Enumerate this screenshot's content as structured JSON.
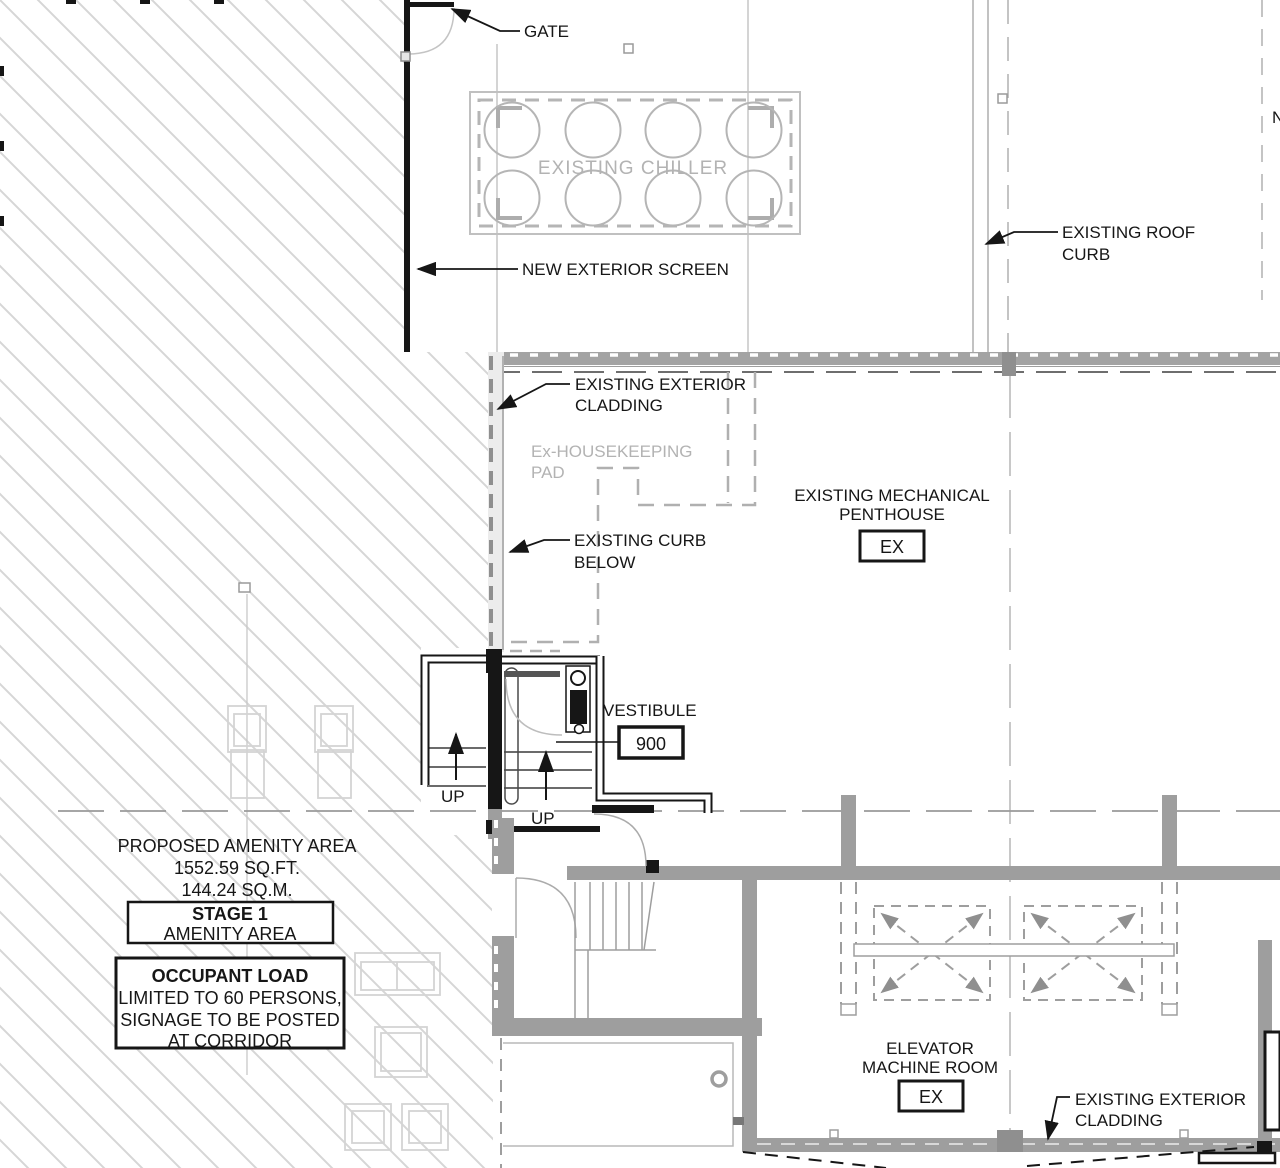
{
  "drawing": {
    "title": "Roof / Penthouse Plan - Stage 1 Amenity Area",
    "colors": {
      "line_black": "#161616",
      "existing_gray": "#9e9e9e",
      "light_line_gray": "#b5b5b5",
      "hatch_gray": "#d6d6d6",
      "gray_text": "#b3b3b3",
      "background": "#ffffff"
    },
    "labels": {
      "gate": "GATE",
      "existing_chiller": "EXISTING CHILLER",
      "new_exterior_screen": "NEW EXTERIOR SCREEN",
      "roof_curb_1": "EXISTING ROOF",
      "roof_curb_2": "CURB",
      "edge_partial": "N",
      "cladding_top_1": "EXISTING EXTERIOR",
      "cladding_top_2": "CLADDING",
      "housekeeping_1": "Ex-HOUSEKEEPING",
      "housekeeping_2": "PAD",
      "penthouse_1": "EXISTING MECHANICAL",
      "penthouse_2": "PENTHOUSE",
      "penthouse_tag": "EX",
      "curb_below_1": "EXISTING CURB",
      "curb_below_2": "BELOW",
      "vestibule": "VESTIBULE",
      "vestibule_number": "900",
      "up_left": "UP",
      "up_right": "UP",
      "amenity_1": "PROPOSED AMENITY AREA",
      "amenity_2": "1552.59 SQ.FT.",
      "amenity_3": "144.24 SQ.M.",
      "stage_1": "STAGE 1",
      "stage_2": "AMENITY AREA",
      "occupant_1": "OCCUPANT LOAD",
      "occupant_2": "LIMITED TO 60 PERSONS,",
      "occupant_3": "SIGNAGE TO BE POSTED",
      "occupant_4": "AT CORRIDOR",
      "elevator_1": "ELEVATOR",
      "elevator_2": "MACHINE ROOM",
      "elevator_tag": "EX",
      "cladding_bottom_1": "EXISTING EXTERIOR",
      "cladding_bottom_2": "CLADDING"
    }
  }
}
